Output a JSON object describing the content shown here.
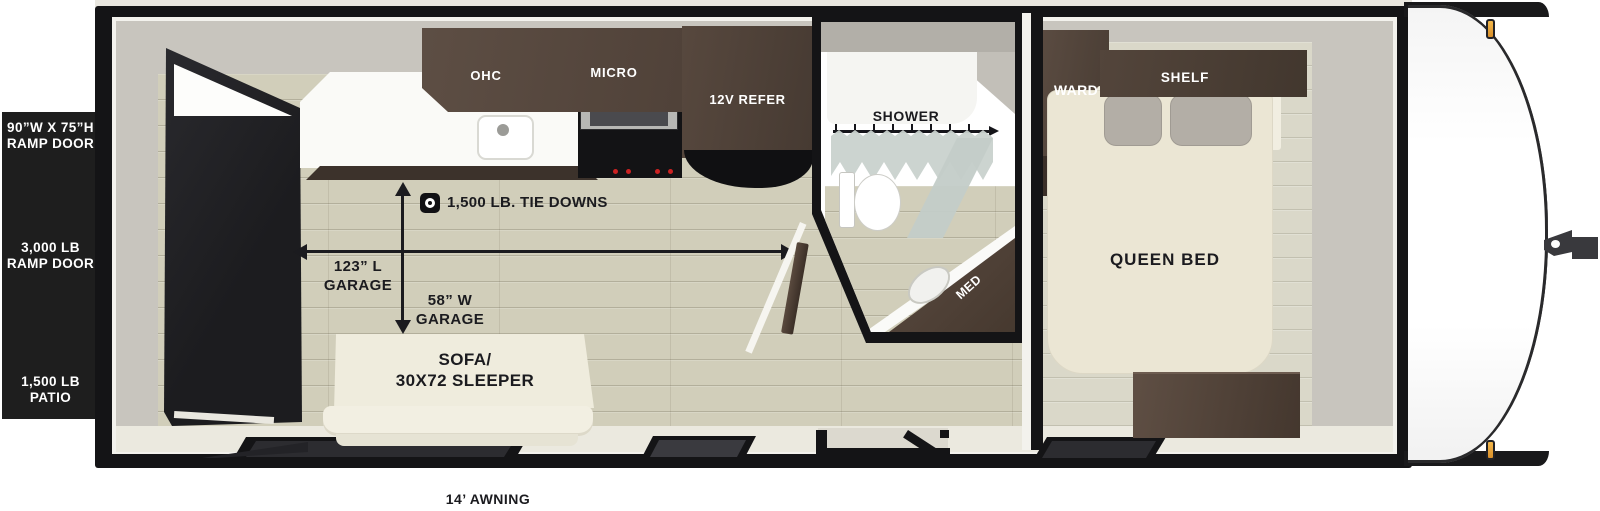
{
  "title": "Toy hauler travel trailer floorplan",
  "left_panel": {
    "labels": [
      {
        "line1": "90”W X 75”H",
        "line2": "RAMP DOOR"
      },
      {
        "line1": "3,000 LB",
        "line2": "RAMP DOOR"
      },
      {
        "line1": "1,500 LB",
        "line2": "PATIO"
      }
    ]
  },
  "kitchen": {
    "ohc_label": "OHC",
    "micro_label": "MICRO",
    "refer_label": "12V REFER"
  },
  "bathroom": {
    "shower_label": "SHOWER",
    "med_label": "MED"
  },
  "bedroom": {
    "ward_label": "WARD",
    "shelf_label": "SHELF",
    "bed_label": "QUEEN BED"
  },
  "garage": {
    "tie_down_label": "1,500 LB. TIE DOWNS",
    "length_line1": "123” L",
    "length_line2": "GARAGE",
    "width_line1": "58” W",
    "width_line2": "GARAGE"
  },
  "sofa": {
    "line1": "SOFA/",
    "line2": "30X72 SLEEPER"
  },
  "awning_label": "14’ AWNING",
  "colors": {
    "shell_black": "#141416",
    "wall_gray": "#c8c5be",
    "floor_tan": "#d1ceba",
    "cabinet_brown": "#53453b",
    "bed_cream": "#ebe6d4",
    "curtain_green_gray": "#c9d2ce",
    "marker_amber": "#ecaf45",
    "ramp_door_dark": "#232327"
  }
}
